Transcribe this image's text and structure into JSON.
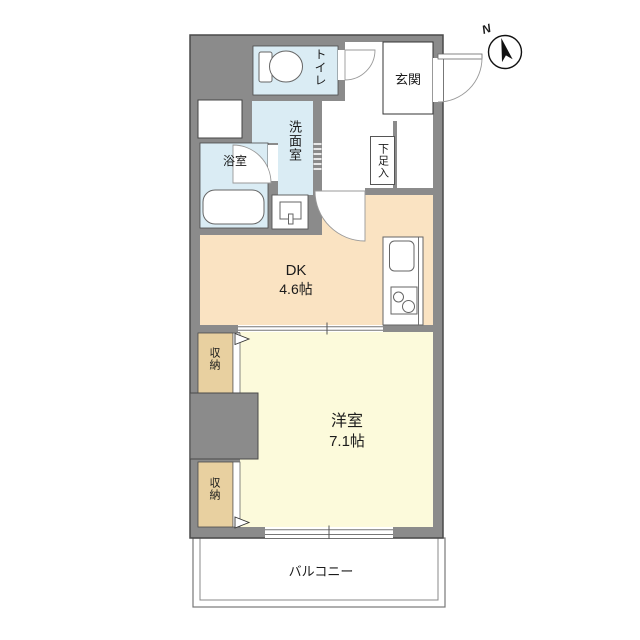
{
  "floorplan": {
    "rooms": {
      "toilet": {
        "label": "トイレ"
      },
      "entrance": {
        "label": "玄関"
      },
      "shoe_storage": {
        "label": "下足入"
      },
      "washroom": {
        "label": "洗面室"
      },
      "bathroom": {
        "label": "浴室"
      },
      "dining_kitchen": {
        "label": "DK",
        "size": "4.6帖"
      },
      "storage_upper": {
        "label": "収納"
      },
      "storage_lower": {
        "label": "収納"
      },
      "western_room": {
        "label": "洋室",
        "size": "7.1帖"
      },
      "balcony": {
        "label": "バルコニー"
      }
    },
    "compass": {
      "label": "N"
    },
    "colors": {
      "wall": "#8b8b8b",
      "line": "#4a4a4a",
      "water": "#daecf4",
      "dk": "#fae3c2",
      "western": "#fcfadb",
      "closet": "#e8d0a0"
    }
  }
}
